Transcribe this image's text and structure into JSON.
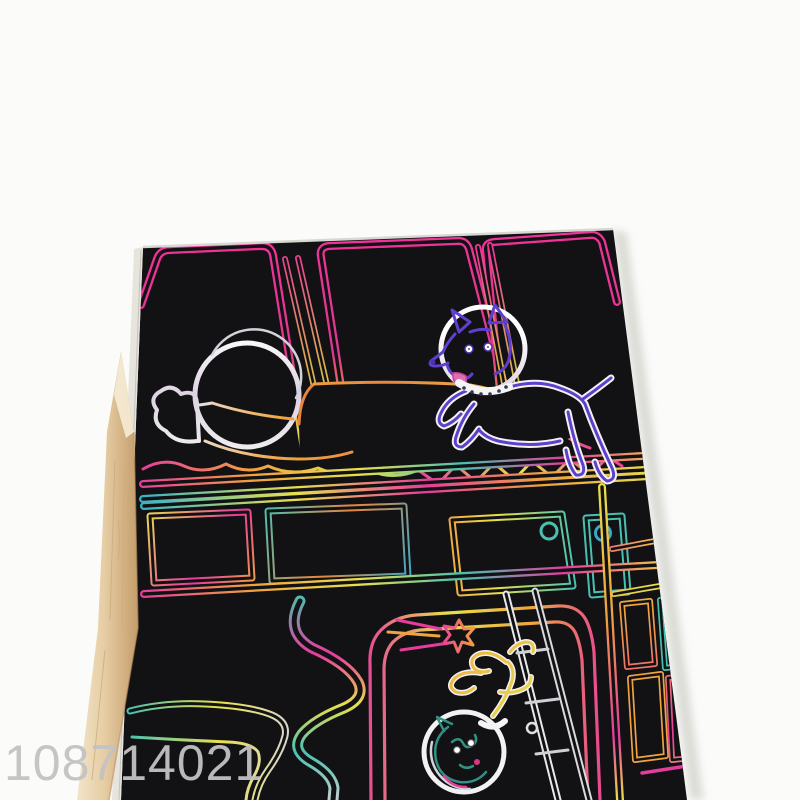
{
  "page": {
    "kind": "product-photo",
    "subject": "rainbow scratch art paper with space scene, black coating scratched to reveal neon rainbow foil, with wooden stylus stick"
  },
  "watermark": {
    "text": "108714021"
  },
  "scene": {
    "elements": [
      "cabin-window-row",
      "sleeping-astronaut",
      "space-dog-in-helmet",
      "bunk-bed-rails",
      "panel-row",
      "wall-pole-grid",
      "door-frame",
      "air-tube",
      "toilet-bowl",
      "shooting-star",
      "ladder",
      "cat-astronaut-in-helmet"
    ],
    "accessory": "wooden-stylus"
  },
  "colors": {
    "background": "#fbfbfa",
    "card": "#0e0d10",
    "paper-edge": "#e7e4de",
    "wood": "#e6cda4",
    "watermark": "#c3c3c3",
    "neon-magenta": "#ef2f96",
    "neon-pink": "#e6399b",
    "neon-orange": "#f0a23c",
    "neon-yellow": "#e8e04a",
    "neon-teal": "#45c0b0",
    "neon-blue": "#35a8c8",
    "neon-purple": "#5c3ccc",
    "silver": "#d9d9d9",
    "white": "#ffffff"
  }
}
